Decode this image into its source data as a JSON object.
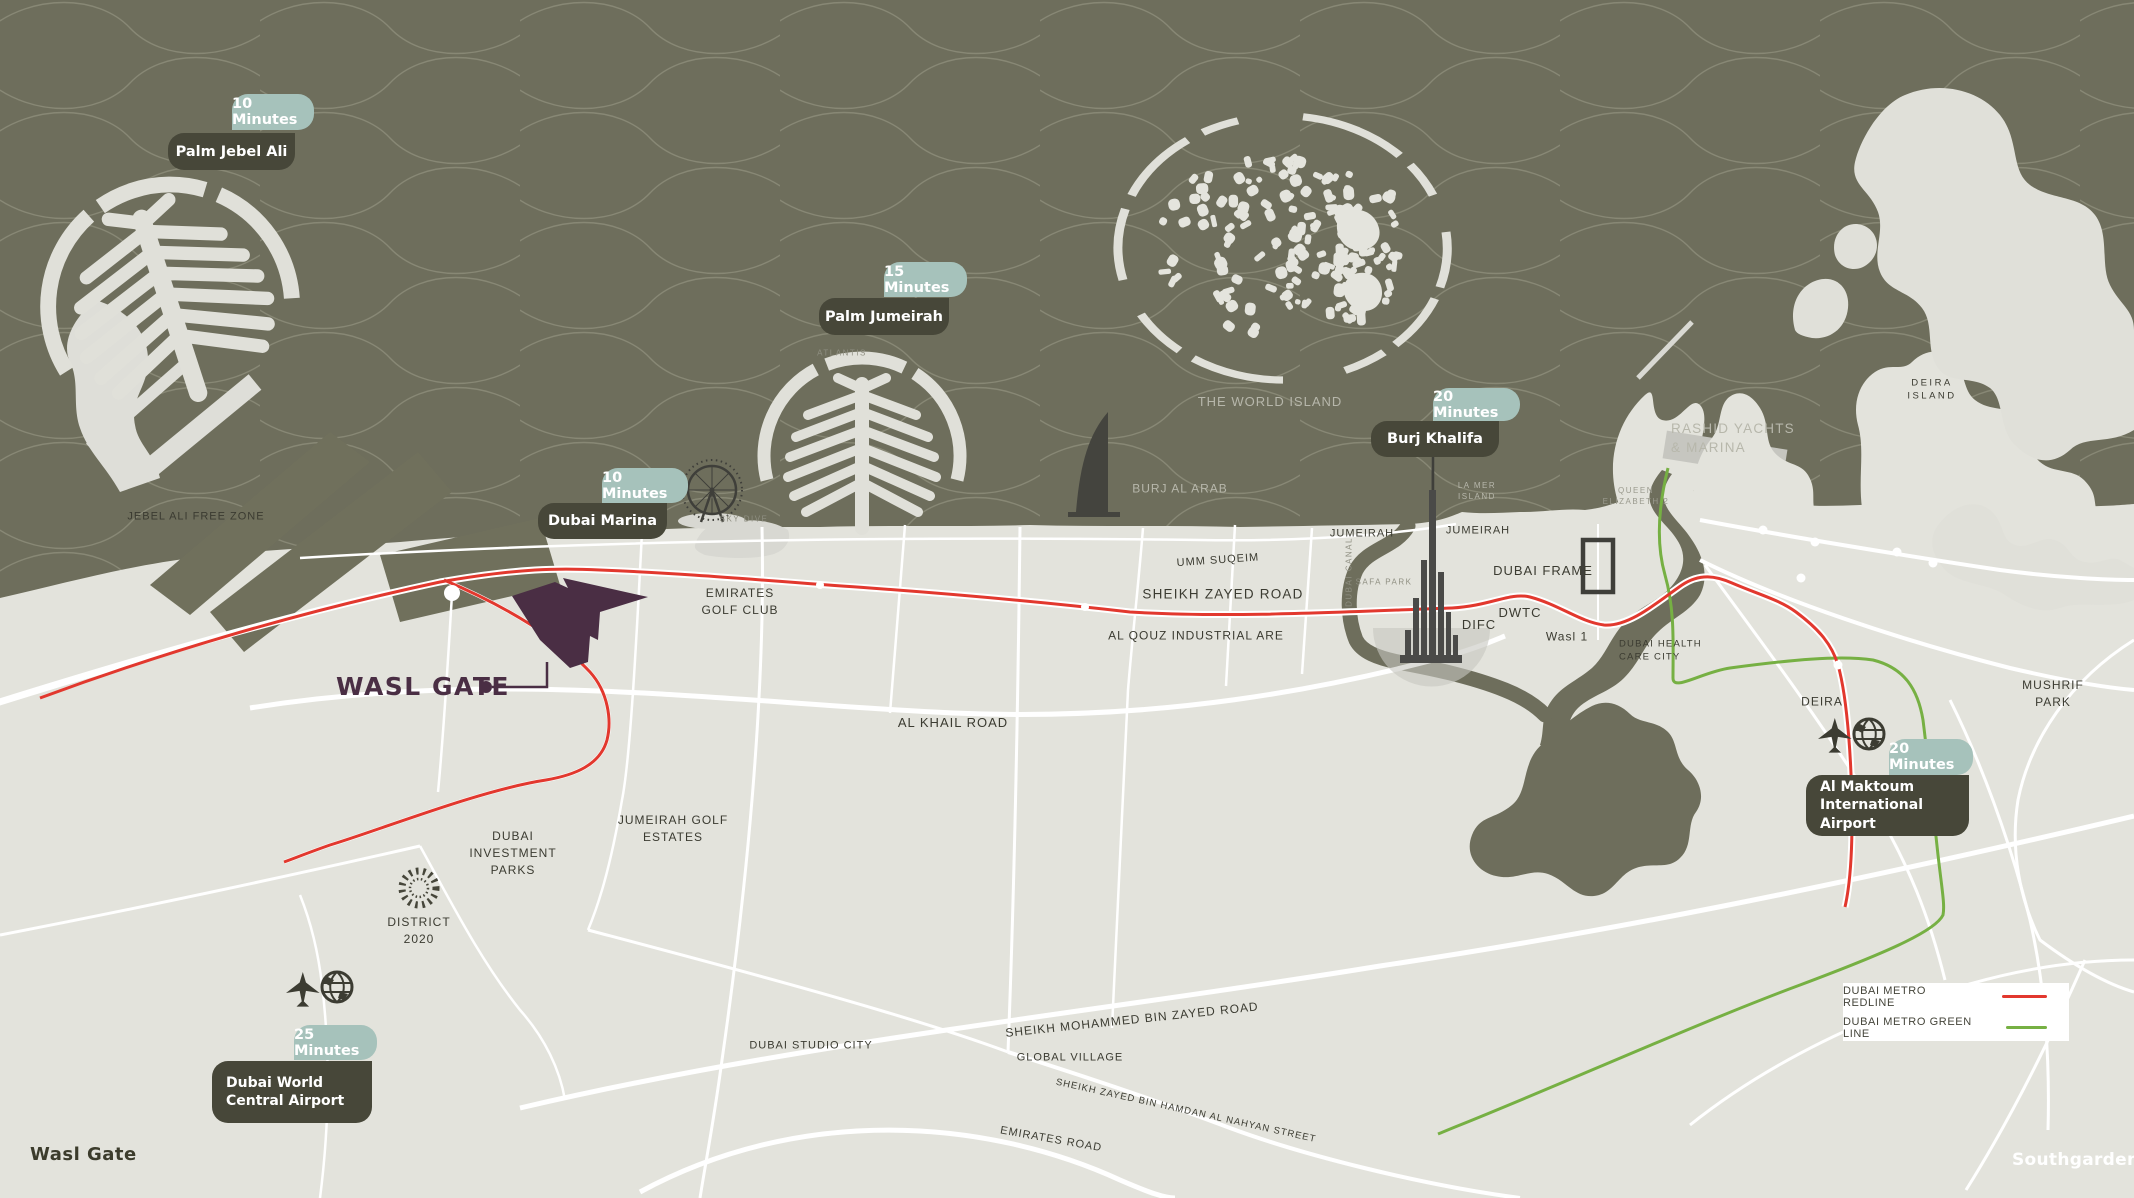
{
  "page": {
    "site_label": "WASL GATE",
    "footer_left": "Wasl Gate",
    "brand": "Southgarden"
  },
  "badges": [
    {
      "time": "10 Minutes",
      "name": "Palm Jebel Ali"
    },
    {
      "time": "15 Minutes",
      "name": "Palm Jumeirah"
    },
    {
      "time": "10 Minutes",
      "name": "Dubai Marina"
    },
    {
      "time": "20 Minutes",
      "name": "Burj Khalifa"
    },
    {
      "time": "20 Minutes",
      "name": "Al Maktoum\nInternational Airport"
    },
    {
      "time": "25 Minutes",
      "name": "Dubai World\nCentral Airport"
    }
  ],
  "labels": [
    {
      "text": "JEBEL ALI FREE ZONE"
    },
    {
      "text": "EMIRATES\nGOLF CLUB"
    },
    {
      "text": "SKY DIVE"
    },
    {
      "text": "ATLANTIS"
    },
    {
      "text": "THE WORLD ISLAND"
    },
    {
      "text": "BURJ AL ARAB"
    },
    {
      "text": "UMM SUQEIM"
    },
    {
      "text": "SHEIKH ZAYED ROAD"
    },
    {
      "text": "AL QOUZ INDUSTRIAL ARE"
    },
    {
      "text": "JUMEIRAH"
    },
    {
      "text": "JUMEIRAH"
    },
    {
      "text": "LA MER\nISLAND"
    },
    {
      "text": "SAFA PARK"
    },
    {
      "text": "DUBAI CANAL"
    },
    {
      "text": "DUBAI FRAME"
    },
    {
      "text": "DWTC"
    },
    {
      "text": "DIFC"
    },
    {
      "text": "Wasl 1"
    },
    {
      "text": "DUBAI HEALTH\nCARE CITY"
    },
    {
      "text": "QUEEN\nELIZABETH 2"
    },
    {
      "text": "RASHID YACHTS\n& MARINA"
    },
    {
      "text": "DEIRA\nISLAND"
    },
    {
      "text": "DEIRA"
    },
    {
      "text": "MUSHRIF PARK"
    },
    {
      "text": "AL KHAIL ROAD"
    },
    {
      "text": "JUMEIRAH GOLF\nESTATES"
    },
    {
      "text": "DUBAI\nINVESTMENT\nPARKS"
    },
    {
      "text": "DISTRICT\n2020"
    },
    {
      "text": "DUBAI STUDIO CITY"
    },
    {
      "text": "SHEIKH MOHAMMED BIN ZAYED ROAD"
    },
    {
      "text": "GLOBAL VILLAGE"
    },
    {
      "text": "SHEIKH ZAYED BIN HAMDAN AL NAHYAN STREET"
    },
    {
      "text": "EMIRATES ROAD"
    }
  ],
  "legend": {
    "items": [
      {
        "label": "DUBAI METRO REDLINE",
        "color": "#e2382e"
      },
      {
        "label": "DUBAI METRO GREEN LINE",
        "color": "#76b043"
      }
    ]
  },
  "colors": {
    "sea": "#6e6e5c",
    "land": "#e3e3dc",
    "badge_teal": "#a6c2bb",
    "badge_dark": "#474739",
    "site_purple": "#4a2e44",
    "metro_red": "#e2382e",
    "metro_green": "#76b043"
  }
}
